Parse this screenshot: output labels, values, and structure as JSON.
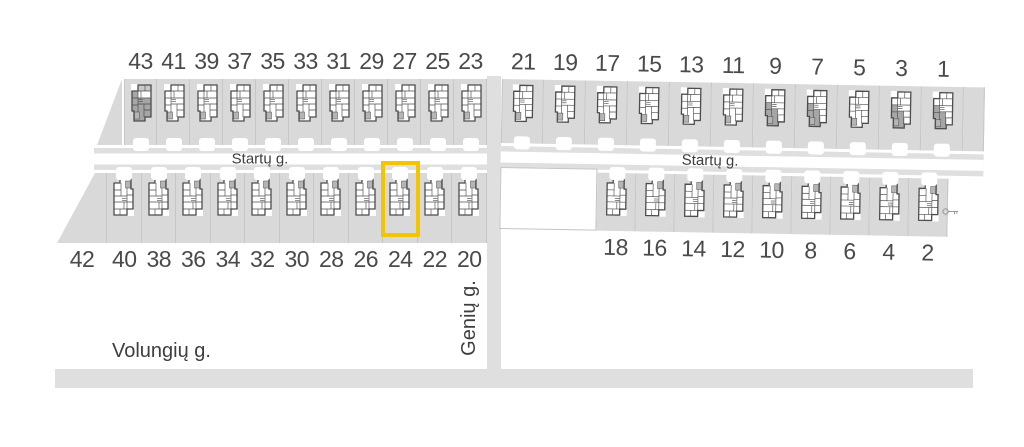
{
  "map_labels": {
    "street_top_left": "Startų g.",
    "street_top_right": "Startų g.",
    "street_vertical": "Genių g.",
    "street_bottom": "Volungių g."
  },
  "highlight": {
    "lot_number": "24",
    "color": "#F2C500"
  },
  "colors": {
    "lot": "#d9d9d9",
    "road": "#dfdfdf",
    "boundary": "#c6c6c6",
    "wall": "#4d4d4d",
    "shade": "#a6a6a6",
    "room_light": "#c9c9c9",
    "pad_gray": "#b5b5b5",
    "text": "#4a4a4a",
    "label": "#3e3e3e",
    "highlight": "#F2C500"
  },
  "icons": {
    "floor_plan": "floor-plan-icon",
    "driveway": "driveway-pad",
    "key_marker": "key-icon"
  },
  "blocks": {
    "top_left": {
      "lots": [
        {
          "number": "43",
          "state": "dark"
        },
        {
          "number": "41",
          "state": "normal"
        },
        {
          "number": "39",
          "state": "normal"
        },
        {
          "number": "37",
          "state": "normal"
        },
        {
          "number": "35",
          "state": "normal"
        },
        {
          "number": "33",
          "state": "normal"
        },
        {
          "number": "31",
          "state": "normal"
        },
        {
          "number": "29",
          "state": "normal"
        },
        {
          "number": "27",
          "state": "normal"
        },
        {
          "number": "25",
          "state": "normal"
        },
        {
          "number": "23",
          "state": "normal"
        }
      ]
    },
    "top_right": {
      "lots": [
        {
          "number": "21",
          "state": "normal"
        },
        {
          "number": "19",
          "state": "normal"
        },
        {
          "number": "17",
          "state": "normal"
        },
        {
          "number": "15",
          "state": "normal"
        },
        {
          "number": "13",
          "state": "normal"
        },
        {
          "number": "11",
          "state": "normal"
        },
        {
          "number": "9",
          "state": "partial"
        },
        {
          "number": "7",
          "state": "partial"
        },
        {
          "number": "5",
          "state": "normal"
        },
        {
          "number": "3",
          "state": "partial"
        },
        {
          "number": "1",
          "state": "partial"
        }
      ]
    },
    "bottom_left": {
      "lots": [
        {
          "number": "42",
          "state": "empty"
        },
        {
          "number": "40",
          "state": "normal"
        },
        {
          "number": "38",
          "state": "normal"
        },
        {
          "number": "36",
          "state": "normal"
        },
        {
          "number": "34",
          "state": "normal"
        },
        {
          "number": "32",
          "state": "normal"
        },
        {
          "number": "30",
          "state": "normal"
        },
        {
          "number": "28",
          "state": "normal"
        },
        {
          "number": "26",
          "state": "normal"
        },
        {
          "number": "24",
          "state": "highlighted"
        },
        {
          "number": "22",
          "state": "normal"
        },
        {
          "number": "20",
          "state": "normal"
        }
      ]
    },
    "bottom_right": {
      "lots": [
        {
          "state": "open"
        },
        {
          "number": "18",
          "state": "normal"
        },
        {
          "number": "16",
          "state": "normal"
        },
        {
          "number": "14",
          "state": "normal"
        },
        {
          "number": "12",
          "state": "normal"
        },
        {
          "number": "10",
          "state": "normal"
        },
        {
          "number": "8",
          "state": "normal"
        },
        {
          "number": "6",
          "state": "normal"
        },
        {
          "number": "4",
          "state": "normal"
        },
        {
          "number": "2",
          "state": "normal"
        }
      ]
    }
  }
}
